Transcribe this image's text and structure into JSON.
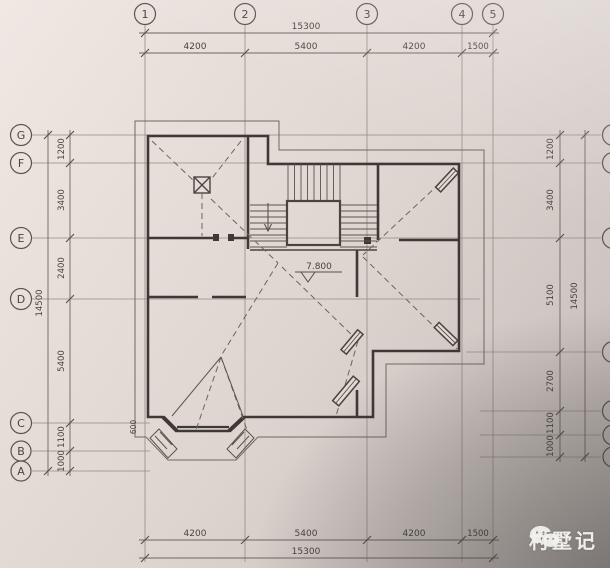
{
  "axes": {
    "top": [
      "1",
      "2",
      "3",
      "4",
      "5"
    ],
    "left": [
      "G",
      "F",
      "E",
      "D",
      "C",
      "B",
      "A"
    ]
  },
  "dims": {
    "top": {
      "total": "15300",
      "segments": [
        "4200",
        "5400",
        "4200",
        "1500"
      ]
    },
    "bottom": {
      "total": "15300",
      "segments": [
        "4200",
        "5400",
        "4200",
        "1500"
      ]
    },
    "left": {
      "total": "14500",
      "segments": [
        "1200",
        "3400",
        "2400",
        "5400",
        "1100",
        "1000"
      ]
    },
    "right": {
      "total": "14500",
      "segments": [
        "1200",
        "3400",
        "5100",
        "2700",
        "1100",
        "1000"
      ]
    }
  },
  "annotations": {
    "level": "7.800",
    "bay_dim": "600"
  },
  "watermark": {
    "text": "村墅记",
    "icon": "wechat-icon"
  },
  "colors": {
    "paper": "#e0d7d2",
    "paper_shadow": "#a39c98",
    "grid_line": "#948b84",
    "dim_line": "#6e655e",
    "wall": "#3f3935",
    "dashed_roof": "#6e645c",
    "text": "#4a433d",
    "watermark_text": "#f6f4f0"
  }
}
